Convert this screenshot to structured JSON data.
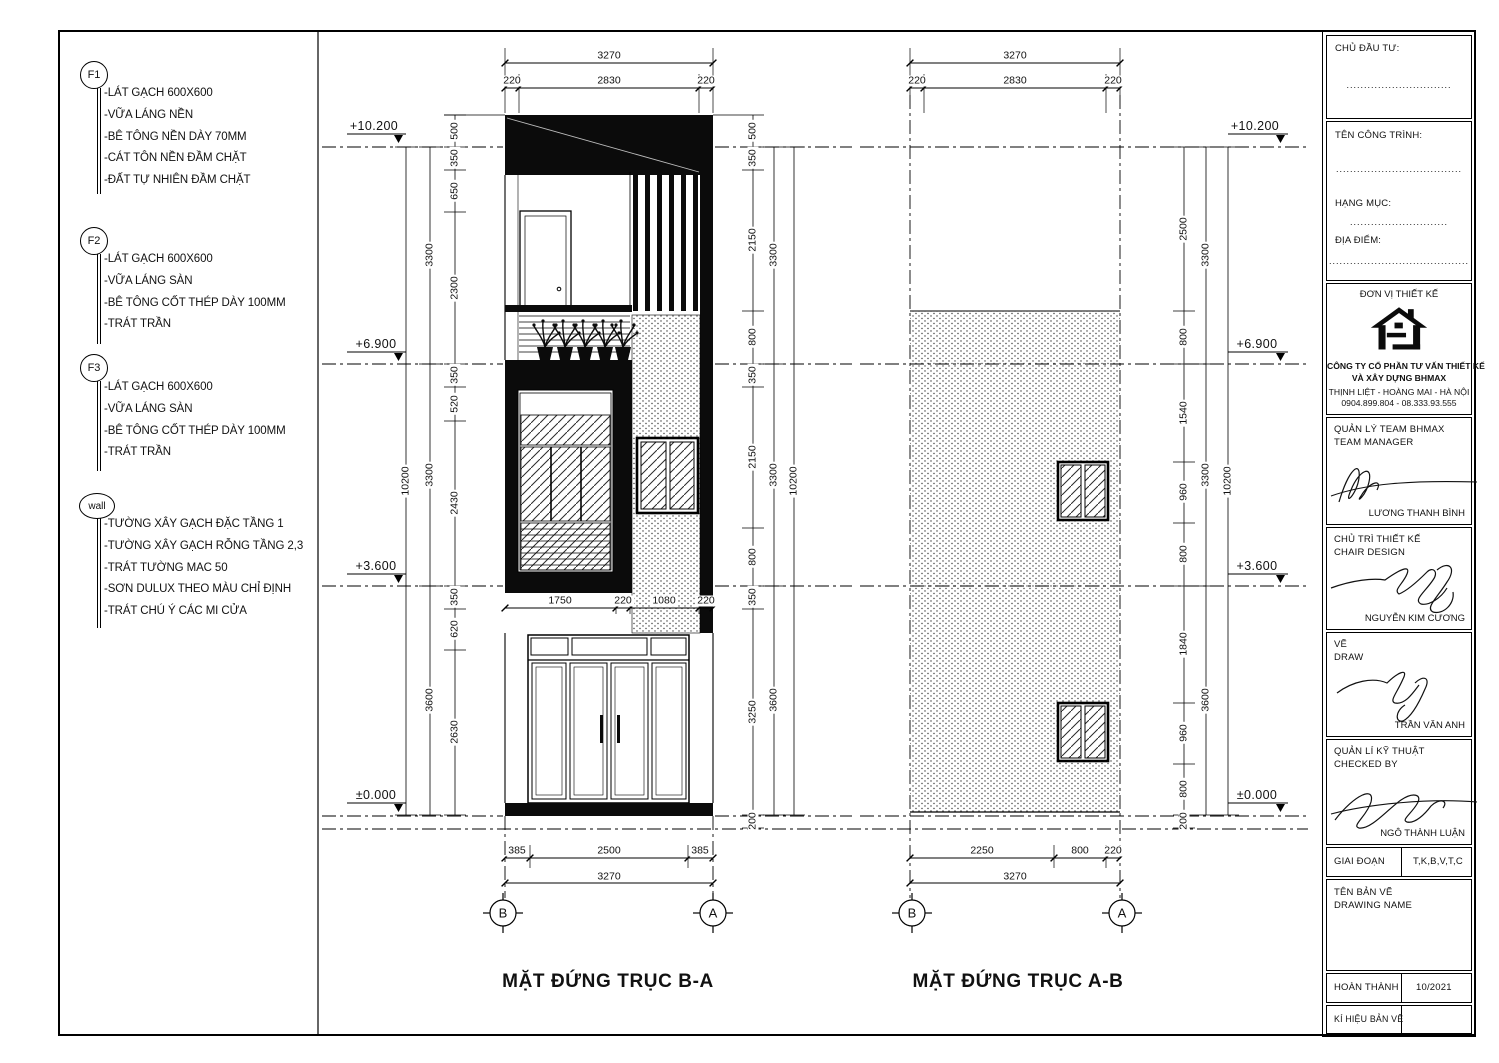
{
  "notes": {
    "f1": {
      "label": "F1",
      "items": [
        "-LÁT GẠCH 600X600",
        "-VỮA LÁNG NỀN",
        "-BÊ TÔNG NỀN DÀY 70MM",
        "-CÁT TÔN NỀN ĐẦM CHẶT",
        "-ĐẤT TỰ NHIÊN ĐẦM CHẶT"
      ]
    },
    "f2": {
      "label": "F2",
      "items": [
        "-LÁT GẠCH 600X600",
        "-VỮA LÁNG SÀN",
        "-BÊ TÔNG CỐT THÉP DÀY 100MM",
        "-TRÁT TRẦN"
      ]
    },
    "f3": {
      "label": "F3",
      "items": [
        "-LÁT GẠCH 600X600",
        "-VỮA LÁNG SÀN",
        "-BÊ TÔNG CỐT THÉP DÀY 100MM",
        "-TRÁT TRẦN"
      ]
    },
    "wall": {
      "label": "wall",
      "items": [
        "-TƯỜNG XÂY GẠCH ĐẶC TẦNG 1",
        "-TƯỜNG XÂY GẠCH RỖNG TẦNG 2,3",
        "-TRÁT TƯỜNG MAC 50",
        "-SƠN DULUX THEO MÀU CHỈ ĐỊNH",
        "-TRÁT CHÚ Ý CÁC MI CỬA"
      ]
    }
  },
  "elev_left": {
    "title": "MẶT ĐỨNG TRỤC B-A",
    "grid_left": "B",
    "grid_right": "A",
    "dims_top": [
      "3270",
      "220",
      "2830",
      "220"
    ],
    "dims_mid": [
      "1750",
      "220",
      "1080",
      "220"
    ],
    "dims_bottom": [
      "385",
      "2500",
      "385",
      "3270"
    ],
    "levels": [
      "+10.200",
      "+6.900",
      "+3.600",
      "±0.000"
    ],
    "chain_left_inner": [
      "500",
      "350",
      "650",
      "2300",
      "350",
      "520",
      "2430",
      "350",
      "620",
      "2630"
    ],
    "chain_left_mid": [
      "3300",
      "3300",
      "3600"
    ],
    "chain_left_outer": "10200",
    "chain_right_inner": [
      "500",
      "350",
      "2150",
      "800",
      "350",
      "2150",
      "800",
      "350",
      "3250",
      "200"
    ],
    "chain_right_mid": [
      "3300",
      "3300",
      "3600"
    ],
    "chain_right_outer": "10200"
  },
  "elev_right": {
    "title": "MẶT ĐỨNG TRỤC A-B",
    "grid_left": "B",
    "grid_right": "A",
    "dims_top": [
      "3270",
      "220",
      "2830",
      "220"
    ],
    "dims_bottom": [
      "2250",
      "800",
      "220",
      "3270"
    ],
    "levels": [
      "+10.200",
      "+6.900",
      "+3.600",
      "±0.000"
    ],
    "chain_right_inner": [
      "2500",
      "800",
      "1540",
      "960",
      "800",
      "1840",
      "960",
      "800",
      "200"
    ],
    "chain_right_mid": [
      "3300",
      "3300",
      "3600"
    ],
    "chain_right_outer": "10200"
  },
  "titleblock": {
    "chu_dau_tu": "CHỦ ĐẦU TƯ:",
    "dots1": "..............................",
    "ten_cong_trinh": "TÊN CÔNG TRÌNH:",
    "dots2": "....................................",
    "hang_muc": "HẠNG MỤC:",
    "dots3": "............................",
    "dia_diem": "ĐỊA ĐIỂM:",
    "dots4": "........................................",
    "don_vi_thiet_ke": "ĐƠN VỊ THIẾT KẾ",
    "company_line1": "CÔNG TY CỔ PHẦN TƯ VẤN THIẾT KẾ",
    "company_line2": "VÀ XÂY DỰNG BHMAX",
    "address": "THỊNH LIỆT - HOÀNG MAI - HÀ NỘI",
    "phone": "0904.899.804 - 08.333.93.555",
    "roles": [
      {
        "title": "QUẢN LÝ TEAM BHMAX",
        "subtitle": "TEAM MANAGER",
        "name": "LƯƠNG THANH BÌNH"
      },
      {
        "title": "CHỦ TRÌ THIẾT KẾ",
        "subtitle": "CHAIR DESIGN",
        "name": "NGUYỄN KIM CƯƠNG"
      },
      {
        "title": "VẼ",
        "subtitle": "DRAW",
        "name": "TRẦN VĂN ANH"
      },
      {
        "title": "QUẢN LÍ KỸ THUẬT",
        "subtitle": "CHECKED BY",
        "name": "NGÔ THÀNH LUẬN"
      }
    ],
    "giai_doan_label": "GIAI ĐOẠN",
    "giai_doan_value": "T,K,B,V,T,C",
    "ten_ban_ve": "TÊN BẢN VẼ",
    "drawing_name": "DRAWING NAME",
    "hoan_thanh_label": "HOÀN THÀNH",
    "hoan_thanh_value": "10/2021",
    "ki_hieu_label": "KÍ HIỆU BẢN VẼ"
  }
}
